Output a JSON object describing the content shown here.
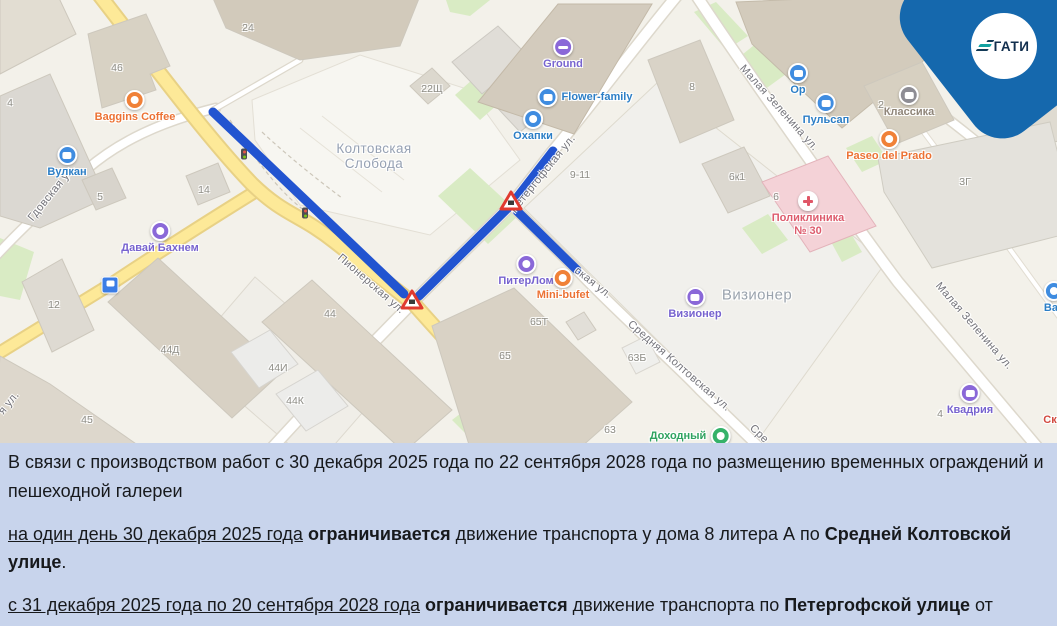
{
  "logo": {
    "text": "ГАТИ"
  },
  "map": {
    "area_labels": [
      "Колтовская Слобода",
      "Визионер"
    ],
    "street_labels": [
      "Гдовская ул.",
      "Пионерская ул.",
      "Петергофская ул.",
      "Средняя Колтовская ул.",
      "Малая Зеленина ул.",
      "Малая Зеленина ул.",
      "Глу",
      "ская ул.",
      "я ул.",
      "Сре"
    ],
    "building_labels": [
      "24",
      "46",
      "4",
      "22Щ",
      "5",
      "14",
      "12",
      "44Д",
      "45",
      "44",
      "44И",
      "44К",
      "9-11",
      "8",
      "2",
      "6к1",
      "6",
      "3",
      "3Г",
      "63Б",
      "65Т",
      "65",
      "63",
      "4"
    ],
    "pois": [
      {
        "label": "Baggins Coffee"
      },
      {
        "label": "Вулкан"
      },
      {
        "label": "Давай Бахнем"
      },
      {
        "label": "Ground"
      },
      {
        "label": "Flower-family"
      },
      {
        "label": "Охапки"
      },
      {
        "label": "ПитерЛом"
      },
      {
        "label": "Mini-bufet"
      },
      {
        "label": "Ор"
      },
      {
        "label": "Пульсап"
      },
      {
        "label": "Классика"
      },
      {
        "label": "Paseo del Prado"
      },
      {
        "label": "Поликлиника № 30"
      },
      {
        "label": "Визионер"
      },
      {
        "label": "Доходный"
      },
      {
        "label": "Квадрия"
      },
      {
        "label": "Вас"
      },
      {
        "label": "Ск"
      }
    ],
    "closure_color": "#2254d0",
    "badge_color": "#1568ad"
  },
  "notice": {
    "p1": "В связи с производством работ с 30 декабря 2025 года по 22 сентября 2028 года по размещению временных ограждений и пешеходной галереи",
    "p2": [
      {
        "t": "на один день 30 декабря 2025 года"
      },
      {
        "t": " "
      },
      {
        "t": "ограничивается"
      },
      {
        "t": " движение транспорта у дома 8 литера А по "
      },
      {
        "t": "Средней Колтовской улице"
      },
      {
        "t": "."
      }
    ],
    "p3": [
      {
        "t": "с 31 декабря 2025 года по 20 сентября 2028 года"
      },
      {
        "t": " "
      },
      {
        "t": "ограничивается"
      },
      {
        "t": " движение транспорта по "
      },
      {
        "t": "Петергофской улице"
      },
      {
        "t": " от Малой Зелениной улицы до Пионерской улицы, по "
      },
      {
        "t": "Пионерской улице"
      },
      {
        "t": " от Петергофской улицы до Гдовской улицы."
      }
    ]
  }
}
